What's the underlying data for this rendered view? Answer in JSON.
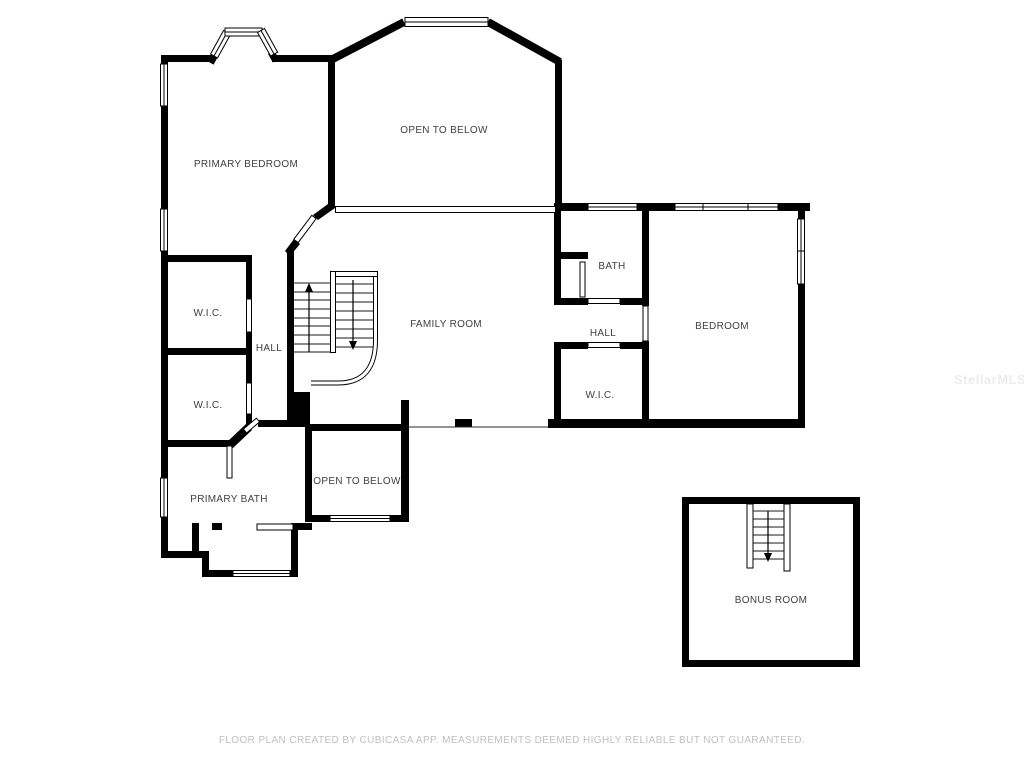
{
  "page": {
    "background": "#ffffff",
    "wall_color": "#000000",
    "label_color": "#404040"
  },
  "floorplan": {
    "rooms": [
      {
        "id": "primary-bedroom",
        "label": "PRIMARY BEDROOM"
      },
      {
        "id": "open-to-below-upper",
        "label": "OPEN TO BELOW"
      },
      {
        "id": "family-room",
        "label": "FAMILY ROOM"
      },
      {
        "id": "bath",
        "label": "BATH"
      },
      {
        "id": "hall-right",
        "label": "HALL"
      },
      {
        "id": "bedroom",
        "label": "BEDROOM"
      },
      {
        "id": "wic-right",
        "label": "W.I.C."
      },
      {
        "id": "wic-left-upper",
        "label": "W.I.C."
      },
      {
        "id": "hall-left",
        "label": "HALL"
      },
      {
        "id": "wic-left-lower",
        "label": "W.I.C."
      },
      {
        "id": "primary-bath",
        "label": "PRIMARY BATH"
      },
      {
        "id": "open-to-below-lower",
        "label": "OPEN TO BELOW"
      },
      {
        "id": "bonus-room",
        "label": "BONUS ROOM"
      }
    ],
    "stairs": [
      {
        "id": "main-stairs-up",
        "direction": "up"
      },
      {
        "id": "main-stairs-down",
        "direction": "down"
      },
      {
        "id": "bonus-stairs-down",
        "direction": "down"
      }
    ],
    "footer": "FLOOR PLAN CREATED BY CUBICASA APP. MEASUREMENTS DEEMED HIGHLY RELIABLE BUT NOT GUARANTEED.",
    "watermark": "StellarMLS"
  }
}
